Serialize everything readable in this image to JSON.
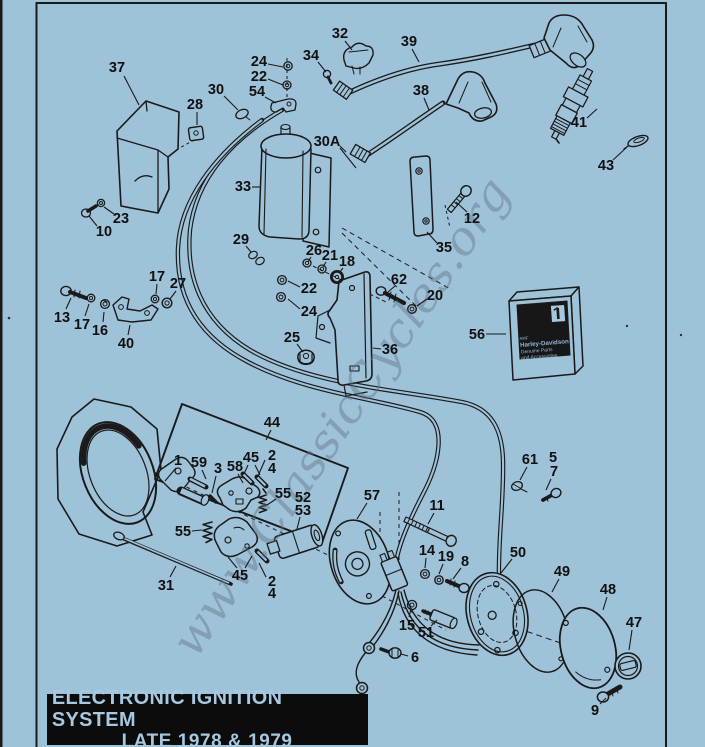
{
  "colors": {
    "background": "#9ec2d8",
    "ink": "#1a1a1a",
    "banner_bg": "#0c0c0c",
    "banner_text": "#a6c8e0",
    "watermark_color": "#5f7082",
    "box_label_bg": "#171717"
  },
  "banner": {
    "line1": "ELECTRONIC IGNITION SYSTEM",
    "line2": "LATE 1978 & 1979"
  },
  "watermark": {
    "text": "www.ClassicCycles.org"
  },
  "parts_box": {
    "corner_mark": "AMF",
    "brand": "Harley-Davidson",
    "line2": "Genuine Parts",
    "line3": "and Accessories",
    "logo": "number-1-logo"
  },
  "callouts": [
    {
      "n": "37",
      "x": 117,
      "y": 67,
      "leaders": [
        [
          124,
          76,
          139,
          105
        ]
      ]
    },
    {
      "n": "28",
      "x": 195,
      "y": 104,
      "leaders": [
        [
          197,
          112,
          197,
          125
        ]
      ]
    },
    {
      "n": "30",
      "x": 216,
      "y": 89,
      "leaders": [
        [
          224,
          96,
          238,
          110
        ]
      ]
    },
    {
      "n": "24",
      "x": 259,
      "y": 61,
      "leaders": [
        [
          268,
          64,
          283,
          67
        ]
      ]
    },
    {
      "n": "22",
      "x": 259,
      "y": 76,
      "leaders": [
        [
          268,
          79,
          283,
          85
        ]
      ]
    },
    {
      "n": "54",
      "x": 257,
      "y": 91,
      "leaders": [
        [
          265,
          97,
          276,
          103
        ]
      ]
    },
    {
      "n": "34",
      "x": 311,
      "y": 55,
      "leaders": [
        [
          318,
          62,
          326,
          72
        ]
      ]
    },
    {
      "n": "32",
      "x": 340,
      "y": 33,
      "leaders": [
        [
          345,
          41,
          352,
          50
        ]
      ]
    },
    {
      "n": "39",
      "x": 409,
      "y": 41,
      "leaders": [
        [
          412,
          49,
          419,
          62
        ]
      ]
    },
    {
      "n": "30A",
      "x": 327,
      "y": 141,
      "leaders": [
        [
          340,
          146,
          346,
          152
        ],
        [
          340,
          148,
          356,
          168
        ]
      ]
    },
    {
      "n": "38",
      "x": 421,
      "y": 90,
      "leaders": [
        [
          424,
          98,
          429,
          110
        ]
      ]
    },
    {
      "n": "41",
      "x": 579,
      "y": 122,
      "leaders": [
        [
          587,
          118,
          597,
          109
        ]
      ]
    },
    {
      "n": "43",
      "x": 606,
      "y": 165,
      "leaders": [
        [
          613,
          160,
          627,
          147
        ]
      ]
    },
    {
      "n": "33",
      "x": 243,
      "y": 186,
      "leaders": [
        [
          252,
          187,
          261,
          187
        ]
      ]
    },
    {
      "n": "12",
      "x": 472,
      "y": 218,
      "leaders": [
        [
          467,
          212,
          456,
          202
        ]
      ]
    },
    {
      "n": "35",
      "x": 444,
      "y": 247,
      "leaders": [
        [
          437,
          243,
          427,
          232
        ]
      ]
    },
    {
      "n": "23",
      "x": 121,
      "y": 218,
      "leaders": [
        [
          114,
          214,
          104,
          207
        ]
      ]
    },
    {
      "n": "10",
      "x": 104,
      "y": 231,
      "leaders": [
        [
          97,
          226,
          89,
          216
        ]
      ]
    },
    {
      "n": "29",
      "x": 241,
      "y": 239,
      "leaders": [
        [
          246,
          246,
          251,
          252
        ]
      ]
    },
    {
      "n": "26",
      "x": 314,
      "y": 250,
      "leaders": [
        [
          311,
          257,
          308,
          262
        ]
      ]
    },
    {
      "n": "21",
      "x": 330,
      "y": 255,
      "leaders": [
        [
          326,
          262,
          323,
          267
        ]
      ]
    },
    {
      "n": "18",
      "x": 347,
      "y": 261,
      "leaders": [
        [
          343,
          268,
          339,
          273
        ]
      ]
    },
    {
      "n": "22",
      "x": 309,
      "y": 288,
      "leaders": [
        [
          300,
          287,
          288,
          281
        ]
      ]
    },
    {
      "n": "24",
      "x": 309,
      "y": 311,
      "leaders": [
        [
          300,
          309,
          288,
          299
        ]
      ]
    },
    {
      "n": "25",
      "x": 292,
      "y": 337,
      "leaders": [
        [
          297,
          344,
          303,
          352
        ]
      ]
    },
    {
      "n": "62",
      "x": 399,
      "y": 279,
      "leaders": [
        [
          395,
          286,
          388,
          292
        ]
      ]
    },
    {
      "n": "20",
      "x": 435,
      "y": 295,
      "leaders": [
        [
          427,
          299,
          417,
          306
        ]
      ]
    },
    {
      "n": "36",
      "x": 390,
      "y": 349,
      "leaders": [
        [
          381,
          349,
          373,
          348
        ]
      ]
    },
    {
      "n": "13",
      "x": 62,
      "y": 317,
      "leaders": [
        [
          66,
          309,
          71,
          298
        ]
      ]
    },
    {
      "n": "17",
      "x": 82,
      "y": 324,
      "leaders": [
        [
          85,
          316,
          89,
          304
        ]
      ]
    },
    {
      "n": "16",
      "x": 100,
      "y": 330,
      "leaders": [
        [
          103,
          322,
          104,
          312
        ]
      ]
    },
    {
      "n": "40",
      "x": 126,
      "y": 343,
      "leaders": [
        [
          128,
          335,
          130,
          325
        ]
      ]
    },
    {
      "n": "17",
      "x": 157,
      "y": 276,
      "leaders": [
        [
          157,
          284,
          156,
          294
        ]
      ]
    },
    {
      "n": "27",
      "x": 178,
      "y": 283,
      "leaders": [
        [
          176,
          291,
          170,
          299
        ]
      ]
    },
    {
      "n": "56",
      "x": 477,
      "y": 334,
      "leaders": [
        [
          486,
          334,
          506,
          334
        ]
      ]
    },
    {
      "n": "44",
      "x": 272,
      "y": 422,
      "leaders": [
        [
          271,
          430,
          266,
          440
        ]
      ]
    },
    {
      "n": "1",
      "x": 178,
      "y": 460,
      "leaders": [
        [
          176,
          468,
          165,
          481
        ]
      ]
    },
    {
      "n": "59",
      "x": 199,
      "y": 462,
      "leaders": [
        [
          202,
          470,
          206,
          479
        ]
      ]
    },
    {
      "n": "3",
      "x": 218,
      "y": 468,
      "leaders": [
        [
          216,
          476,
          212,
          493
        ]
      ]
    },
    {
      "n": "58",
      "x": 235,
      "y": 466,
      "leaders": [
        [
          238,
          474,
          243,
          483
        ]
      ]
    },
    {
      "n": "45",
      "x": 251,
      "y": 457,
      "leaders": [
        [
          248,
          465,
          244,
          474
        ],
        [
          255,
          465,
          260,
          475
        ]
      ]
    },
    {
      "n": "2",
      "x": 272,
      "y": 455
    },
    {
      "n": "4",
      "x": 272,
      "y": 468,
      "leaders": [
        [
          265,
          460,
          258,
          476
        ]
      ]
    },
    {
      "n": "55",
      "x": 283,
      "y": 493,
      "leaders": [
        [
          276,
          499,
          267,
          505
        ]
      ]
    },
    {
      "n": "52",
      "x": 303,
      "y": 497
    },
    {
      "n": "53",
      "x": 303,
      "y": 510,
      "leaders": [
        [
          300,
          517,
          297,
          529
        ]
      ]
    },
    {
      "n": "55",
      "x": 183,
      "y": 531,
      "leaders": [
        [
          192,
          531,
          202,
          530
        ]
      ]
    },
    {
      "n": "31",
      "x": 166,
      "y": 585,
      "leaders": [
        [
          170,
          577,
          176,
          566
        ]
      ]
    },
    {
      "n": "57",
      "x": 372,
      "y": 495,
      "leaders": [
        [
          367,
          503,
          357,
          519
        ]
      ]
    },
    {
      "n": "11",
      "x": 437,
      "y": 505,
      "leaders": [
        [
          434,
          513,
          428,
          524
        ]
      ]
    },
    {
      "n": "14",
      "x": 427,
      "y": 550,
      "leaders": [
        [
          426,
          558,
          425,
          568
        ]
      ]
    },
    {
      "n": "19",
      "x": 446,
      "y": 556,
      "leaders": [
        [
          443,
          564,
          439,
          574
        ]
      ]
    },
    {
      "n": "8",
      "x": 465,
      "y": 561,
      "leaders": [
        [
          461,
          568,
          453,
          579
        ]
      ]
    },
    {
      "n": "15",
      "x": 407,
      "y": 625,
      "leaders": [
        [
          409,
          617,
          411,
          609
        ]
      ]
    },
    {
      "n": "51",
      "x": 426,
      "y": 632,
      "leaders": [
        [
          431,
          626,
          437,
          620
        ]
      ]
    },
    {
      "n": "6",
      "x": 415,
      "y": 657,
      "leaders": [
        [
          408,
          656,
          401,
          654
        ]
      ]
    },
    {
      "n": "61",
      "x": 530,
      "y": 459,
      "leaders": [
        [
          527,
          467,
          520,
          480
        ]
      ]
    },
    {
      "n": "5",
      "x": 553,
      "y": 457
    },
    {
      "n": "7",
      "x": 554,
      "y": 471,
      "leaders": [
        [
          551,
          479,
          546,
          490
        ]
      ]
    },
    {
      "n": "50",
      "x": 518,
      "y": 552,
      "leaders": [
        [
          512,
          559,
          501,
          573
        ]
      ]
    },
    {
      "n": "49",
      "x": 562,
      "y": 571,
      "leaders": [
        [
          559,
          579,
          552,
          592
        ]
      ]
    },
    {
      "n": "48",
      "x": 608,
      "y": 589,
      "leaders": [
        [
          607,
          597,
          603,
          610
        ]
      ]
    },
    {
      "n": "47",
      "x": 634,
      "y": 622,
      "leaders": [
        [
          632,
          630,
          629,
          650
        ]
      ]
    },
    {
      "n": "9",
      "x": 595,
      "y": 710,
      "leaders": [
        [
          600,
          704,
          606,
          698
        ]
      ]
    },
    {
      "n": "45",
      "x": 240,
      "y": 575,
      "leaders": [
        [
          237,
          568,
          228,
          557
        ],
        [
          245,
          568,
          252,
          556
        ]
      ]
    },
    {
      "n": "2",
      "x": 272,
      "y": 581,
      "leaders": [
        [
          266,
          577,
          259,
          563
        ]
      ]
    },
    {
      "n": "4",
      "x": 272,
      "y": 593
    }
  ]
}
